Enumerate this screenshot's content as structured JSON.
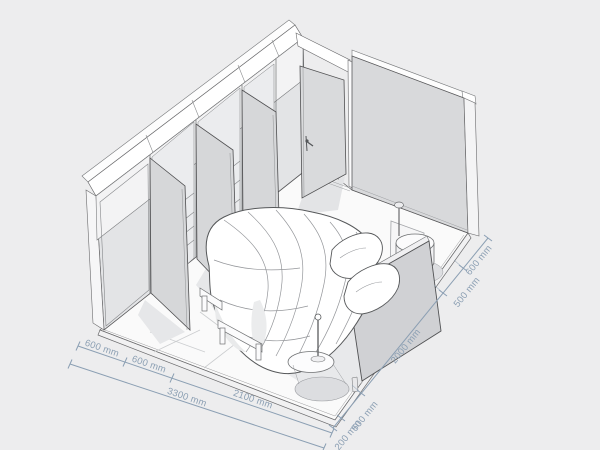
{
  "scene": {
    "type": "isometric-bedroom-plan",
    "units": "mm",
    "colors": {
      "background": "#ededee",
      "wall_fill": "#d8d9db",
      "wardrobe_fill": "#e3e4e6",
      "floor_fill": "#fafafa",
      "shadow": "#e6e7e9",
      "outline": "#56585a",
      "dimension_accent": "#8b9fb3"
    }
  },
  "dimensions": {
    "bottom_left": {
      "segments": [
        "600 mm",
        "600 mm",
        "2100 mm"
      ],
      "total": "3300 mm"
    },
    "bottom_right": {
      "segments": [
        "200 mm",
        "500 mm",
        "2000 mm",
        "500 mm",
        "600 mm"
      ]
    }
  }
}
